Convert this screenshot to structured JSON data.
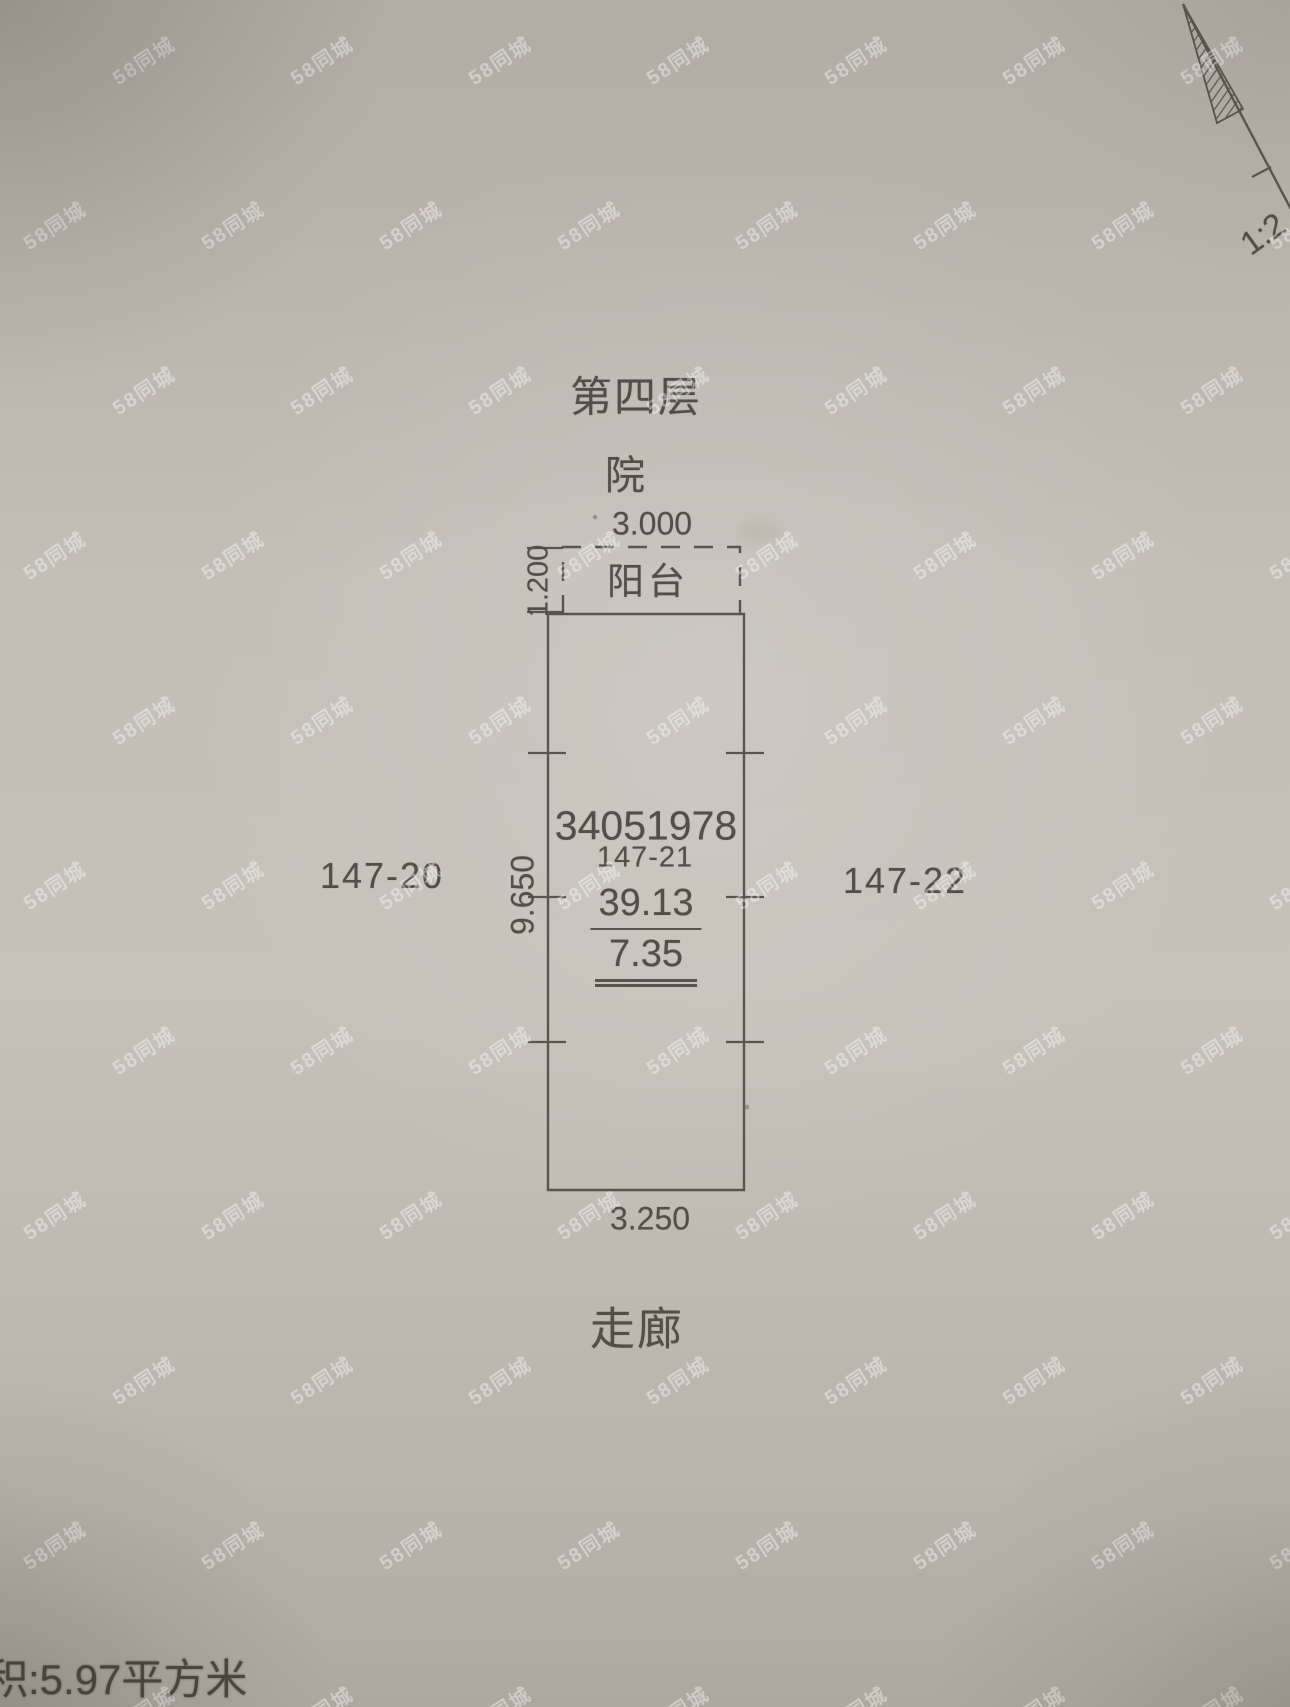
{
  "photo": {
    "floor_title": "第四层",
    "courtyard_label": "院",
    "balcony_label": "阳台",
    "corridor_label": "走廊",
    "dims": {
      "balcony_width": "3.000",
      "balcony_depth": "1.200",
      "parcel_height": "9.650",
      "parcel_width_bottom": "3.250"
    },
    "parcel": {
      "certificate_number": "34051978",
      "parcel_id": "147-21",
      "area": "39.13",
      "inner_area": "7.35"
    },
    "neighbors": {
      "left": "147-20",
      "right": "147-22"
    },
    "bottom_note": "积:5.97平方米",
    "scale_label": "1:2",
    "ink_color": "#534e47",
    "paper_color": "#c3beb6",
    "watermark_color": "#ffffff"
  },
  "watermark": {
    "text": "58同城",
    "rotation_deg": -33,
    "font_size": 20,
    "opacity": 0.4,
    "cols": 8,
    "rows": 11,
    "dx": 178,
    "dy": 165,
    "x0": -70,
    "y0": 45,
    "row_offset": 89
  }
}
